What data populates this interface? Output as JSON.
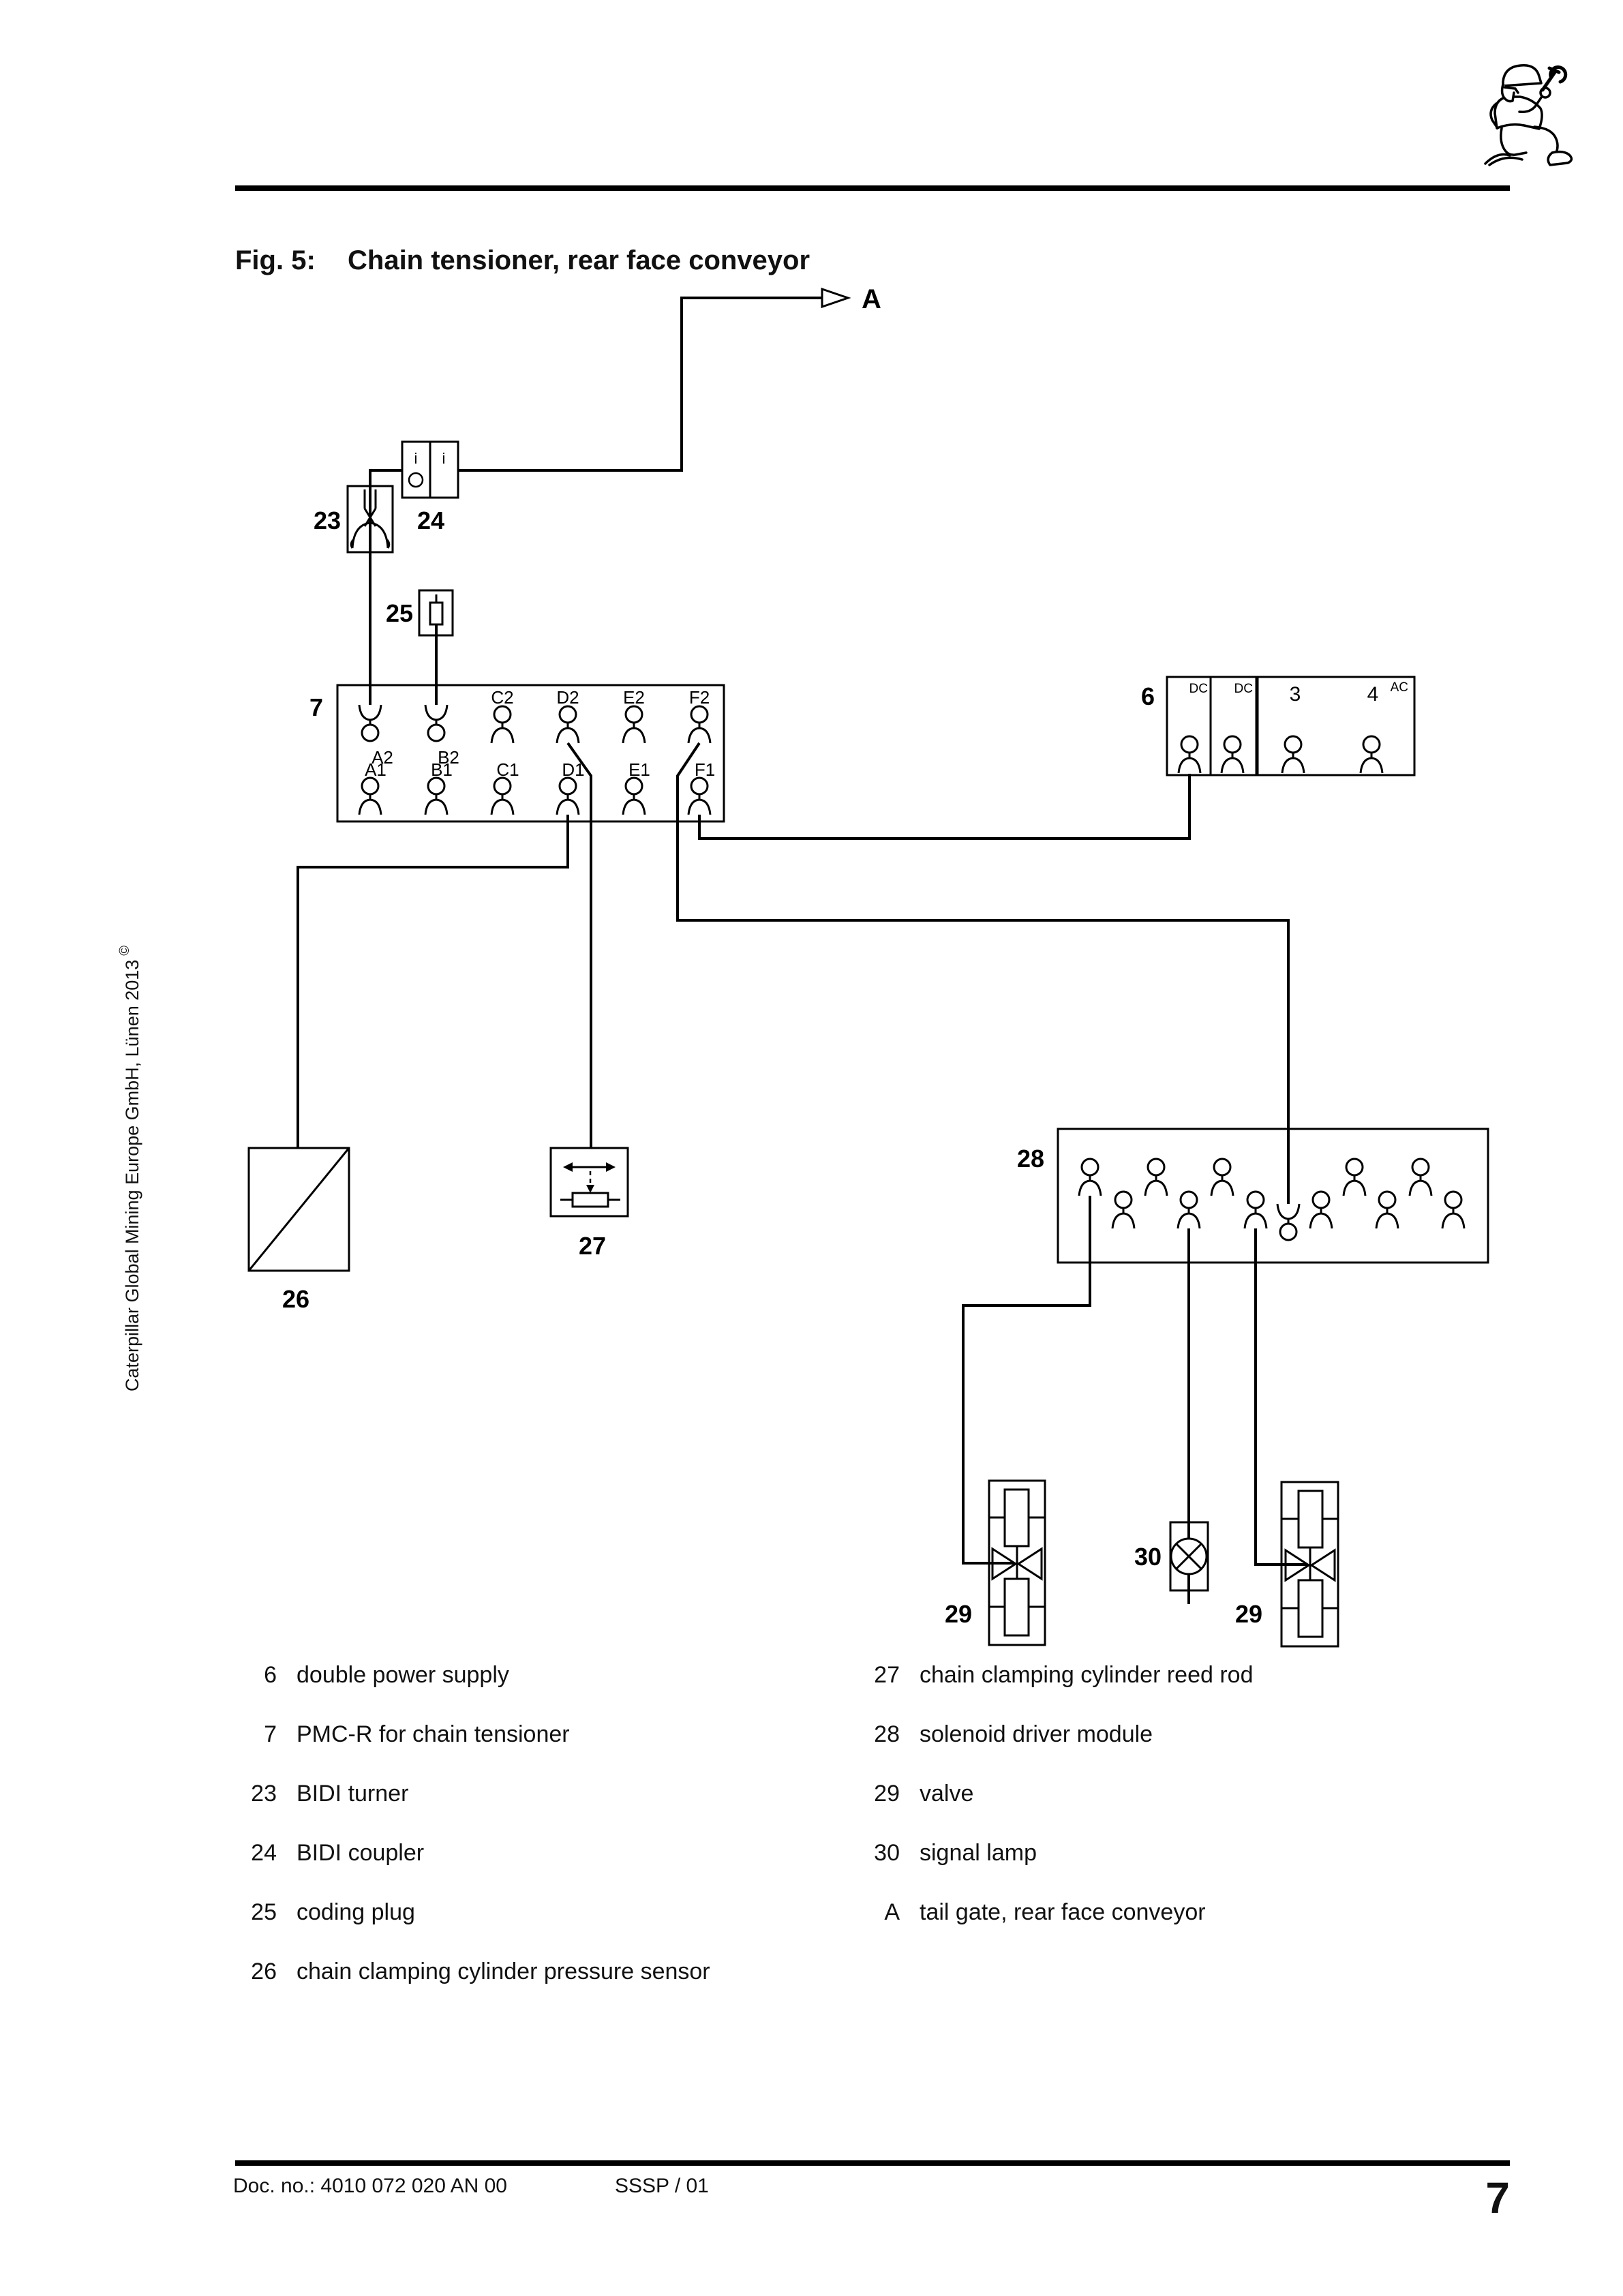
{
  "title": {
    "fig": "Fig. 5:",
    "text": "Chain tensioner, rear face conveyor"
  },
  "sidebar": {
    "copyright": "Caterpillar Global Mining Europe GmbH, Lünen 2013",
    "symbol": "©"
  },
  "diagram": {
    "ref_label": "A",
    "bidi_turner": {
      "id": "23"
    },
    "bidi_coupler": {
      "id": "24",
      "port_labels": [
        "i",
        "i"
      ]
    },
    "coding_plug": {
      "id": "25"
    },
    "pmcr": {
      "id": "7",
      "ports_top": [
        "A2",
        "B2",
        "C2",
        "D2",
        "E2",
        "F2"
      ],
      "ports_bottom": [
        "A1",
        "B1",
        "C1",
        "D1",
        "E1",
        "F1"
      ]
    },
    "power_supply": {
      "id": "6",
      "cell_labels": [
        "DC",
        "DC",
        "AC"
      ],
      "channel_labels": [
        "3",
        "4"
      ]
    },
    "pressure_sensor": {
      "id": "26"
    },
    "reed_rod": {
      "id": "27"
    },
    "solenoid_driver": {
      "id": "28"
    },
    "valve_left": {
      "id": "29"
    },
    "valve_right": {
      "id": "29"
    },
    "signal_lamp": {
      "id": "30"
    }
  },
  "legend": {
    "left": [
      {
        "num": "6",
        "label": "double power supply"
      },
      {
        "num": "7",
        "label": "PMC-R for chain tensioner"
      },
      {
        "num": "23",
        "label": "BIDI turner"
      },
      {
        "num": "24",
        "label": "BIDI coupler"
      },
      {
        "num": "25",
        "label": "coding plug"
      },
      {
        "num": "26",
        "label": "chain clamping cylinder pressure sensor"
      }
    ],
    "right": [
      {
        "num": "27",
        "label": "chain clamping cylinder reed rod"
      },
      {
        "num": "28",
        "label": "solenoid driver module"
      },
      {
        "num": "29",
        "label": "valve"
      },
      {
        "num": "30",
        "label": "signal lamp"
      },
      {
        "num": "A",
        "label": "tail gate, rear face conveyor"
      }
    ]
  },
  "footer": {
    "doc_no": "Doc. no.: 4010 072 020 AN 00",
    "revision": "SSSP / 01",
    "page": "7"
  }
}
